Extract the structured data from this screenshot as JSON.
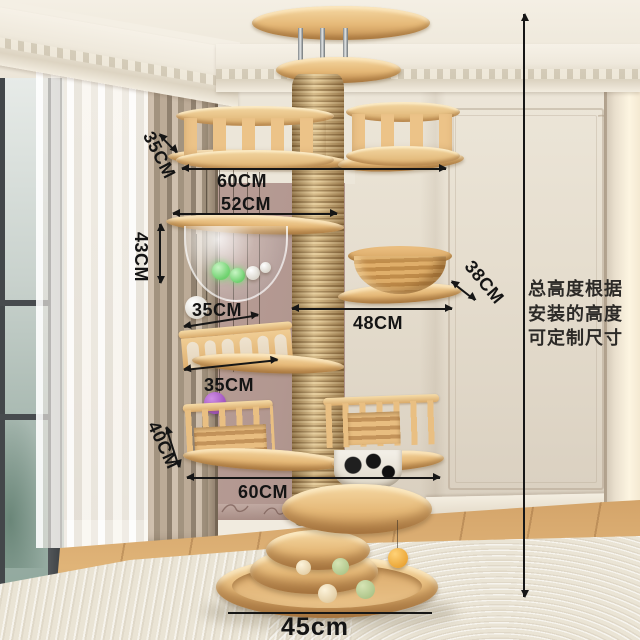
{
  "product": {
    "type": "ceiling-mounted wooden cat climbing tree in a living room corner"
  },
  "annotations": {
    "upper_basket_height": "35CM",
    "top_level_width": "60CM",
    "capsule_platform_width": "52CM",
    "capsule_level_height": "43CM",
    "basket_bowl_width": "38CM",
    "arch_fence_width": "35CM",
    "bowl_platform_width": "48CM",
    "arch_platform_width": "35CM",
    "play_pen_height": "40CM",
    "lower_level_width": "60CM",
    "base_width": "45cm"
  },
  "note_lines": [
    "总高度根据",
    "安装的高度",
    "可定制尺寸"
  ],
  "colors": {
    "wood": "#e5b877",
    "sisal_rope": "#c6a671",
    "accent_wall": "#b29790",
    "annotation_ink": "#161616",
    "rug": "#eae4d5",
    "floor_wood": "#d8ab6e"
  }
}
